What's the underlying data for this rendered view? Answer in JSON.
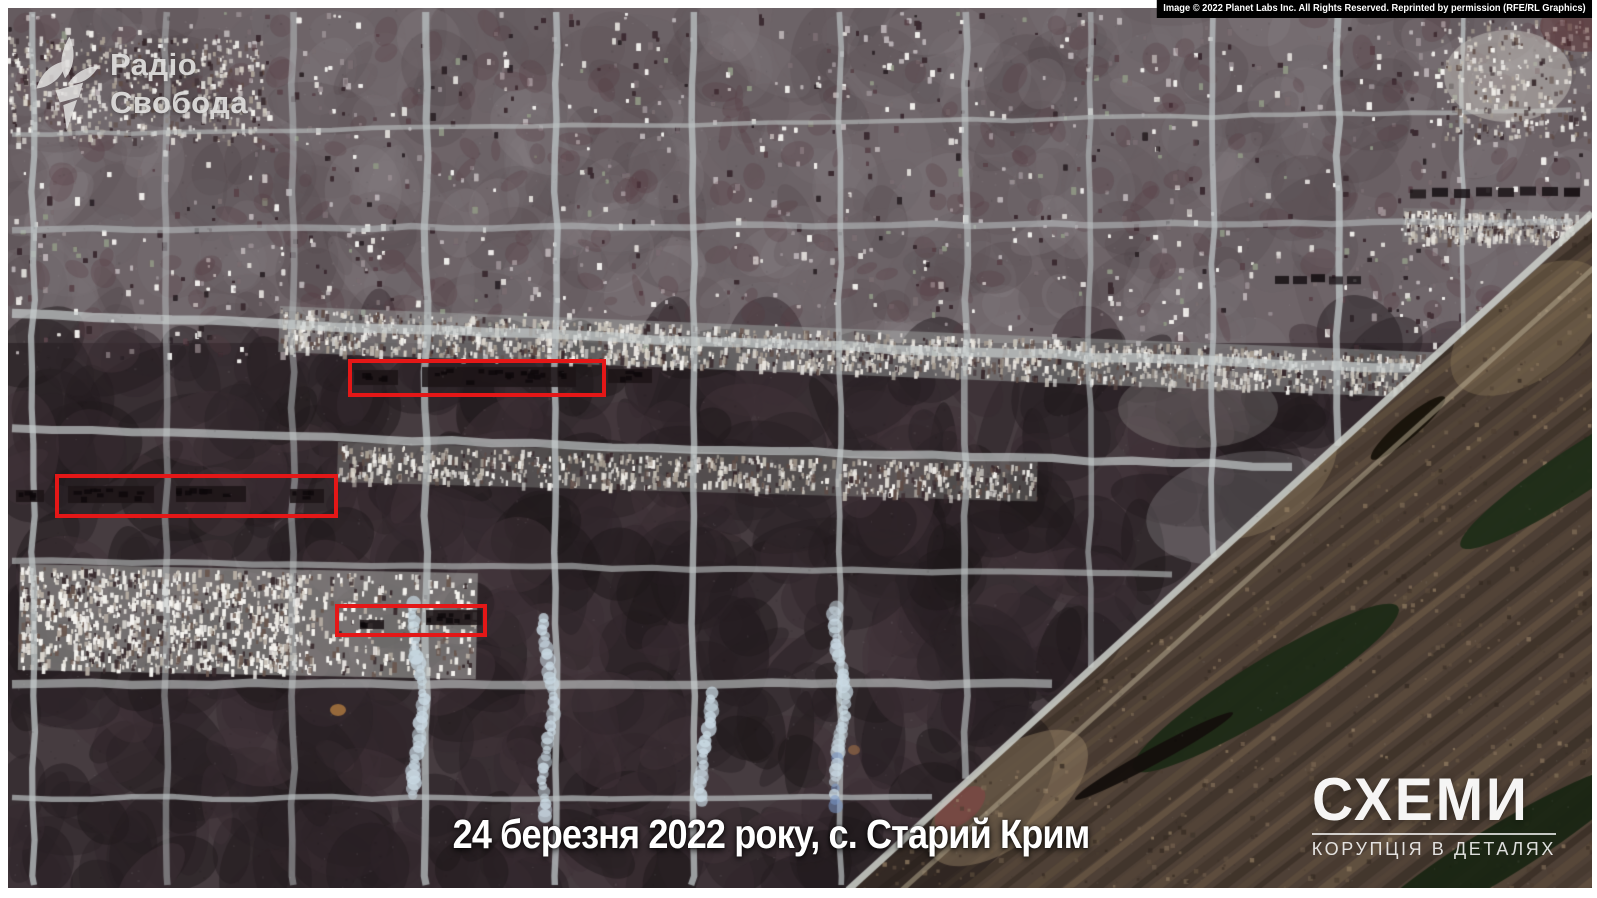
{
  "copyright_bar": {
    "text": "Image © 2022 Planet Labs Inc. All Rights Reserved. Reprinted by permission (RFE/RL Graphics)"
  },
  "logo": {
    "line1": "Радіо",
    "line2": "Свобода",
    "icon": "rferl-torch-icon"
  },
  "caption": {
    "text": "24 березня 2022 року, с. Старий Крим"
  },
  "watermark": {
    "title": "СХЕМИ",
    "subtitle": "КОРУПЦІЯ В ДЕТАЛЯХ"
  },
  "annotations": {
    "color": "#e41717",
    "boxes": [
      {
        "left": 340,
        "top": 351,
        "width": 258,
        "height": 38
      },
      {
        "left": 47,
        "top": 466,
        "width": 283,
        "height": 44
      },
      {
        "left": 327,
        "top": 596,
        "width": 152,
        "height": 33
      }
    ]
  }
}
